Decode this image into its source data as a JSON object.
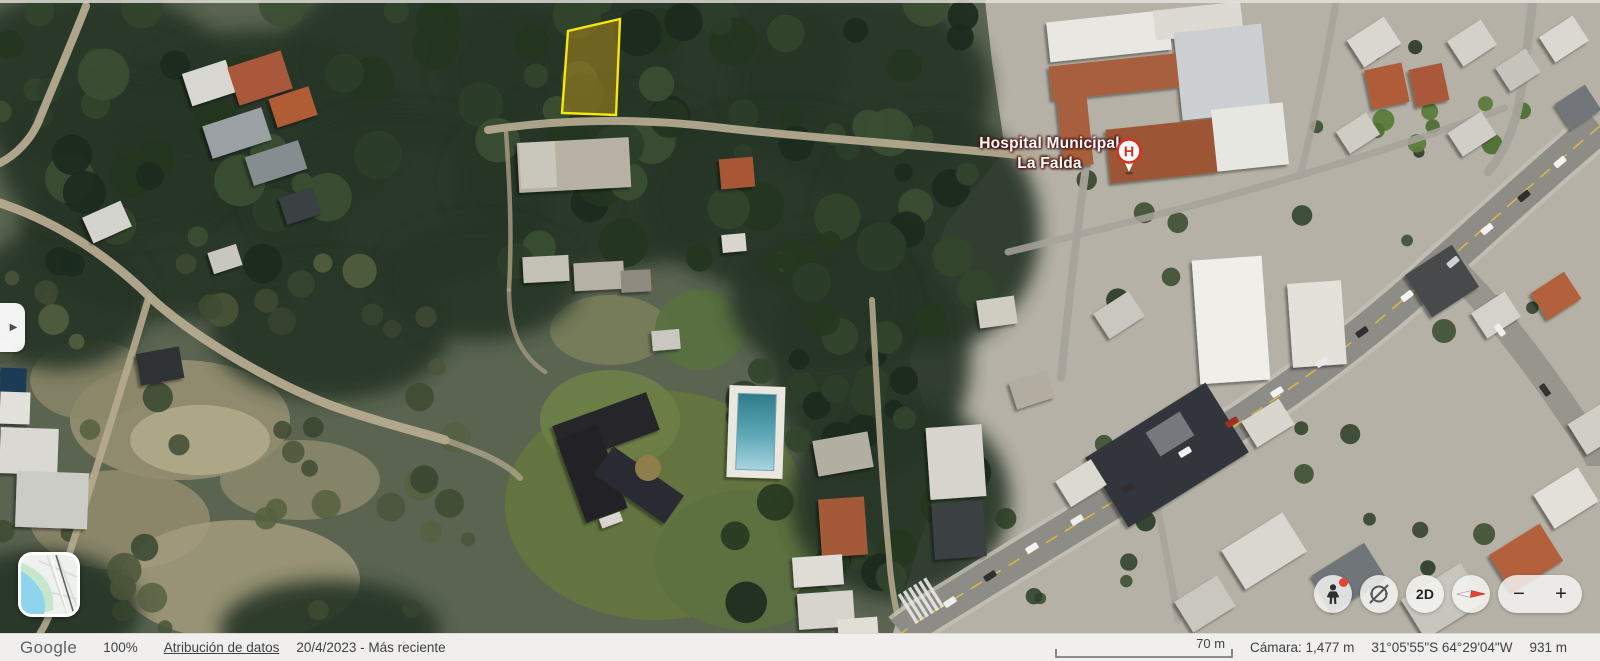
{
  "map": {
    "poi": {
      "hospital": {
        "line1": "Hospital Municipal",
        "line2": "La Falda",
        "pin_letter": "H",
        "pin_color": "#d93025"
      }
    },
    "parcel": {
      "points": "620,19 568,31 562,113 616,115",
      "stroke": "#f6e80a",
      "fill": "#9c7f1f"
    }
  },
  "side_tab": {
    "icon": "chevron-right",
    "glyph": "▶"
  },
  "controls": {
    "twod_label": "2D",
    "zoom_out_glyph": "−",
    "zoom_in_glyph": "+",
    "pegman_dot_color": "#e94335"
  },
  "statusbar": {
    "logo": "Google",
    "zoom_percent": "100%",
    "attribution": "Atribución de datos",
    "date": "20/4/2023 - Más reciente",
    "scale_label": "70 m",
    "camera": "Cámara: 1,477 m",
    "coordinates": "31°05'55\"S 64°29'04\"W",
    "elevation": "931 m"
  }
}
